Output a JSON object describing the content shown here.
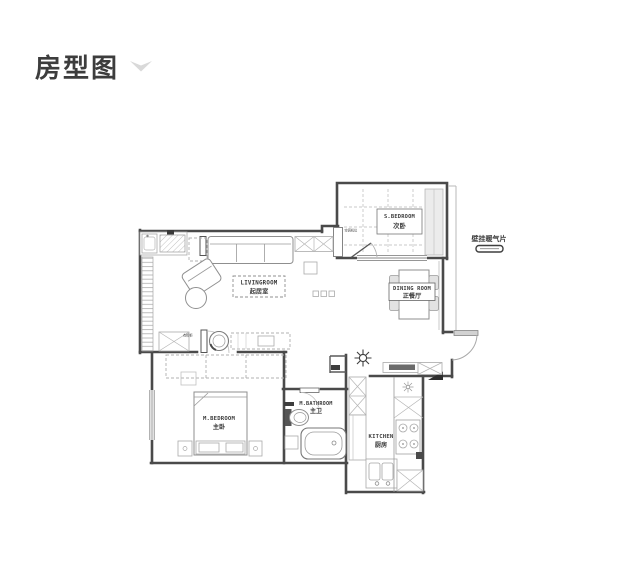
{
  "header": {
    "title": "房型图"
  },
  "floorplan": {
    "rooms": {
      "s_bedroom": {
        "en": "S.BEDROOM",
        "zh": "次卧"
      },
      "dining": {
        "en": "DINING ROOM",
        "zh": "正餐厅"
      },
      "living": {
        "en": "LIVINGROOM",
        "zh": "起居室"
      },
      "m_bedroom": {
        "en": "M.BEDROOM",
        "zh": "主卧"
      },
      "m_bathroom": {
        "en": "M.BATHROOM",
        "zh": "主卫"
      },
      "kitchen": {
        "en": "KITCHEN",
        "zh": "厨房"
      }
    },
    "annotations": {
      "radiator": "壁挂暖气片",
      "ac_unit": "空调机位",
      "closet": "衣帽柜"
    },
    "colors": {
      "wall": "#4a4a4a",
      "furniture": "#8f8f8f",
      "light_fill": "#ececec",
      "label": "#3b3b3b",
      "chevron": "#d9d9d9"
    }
  }
}
